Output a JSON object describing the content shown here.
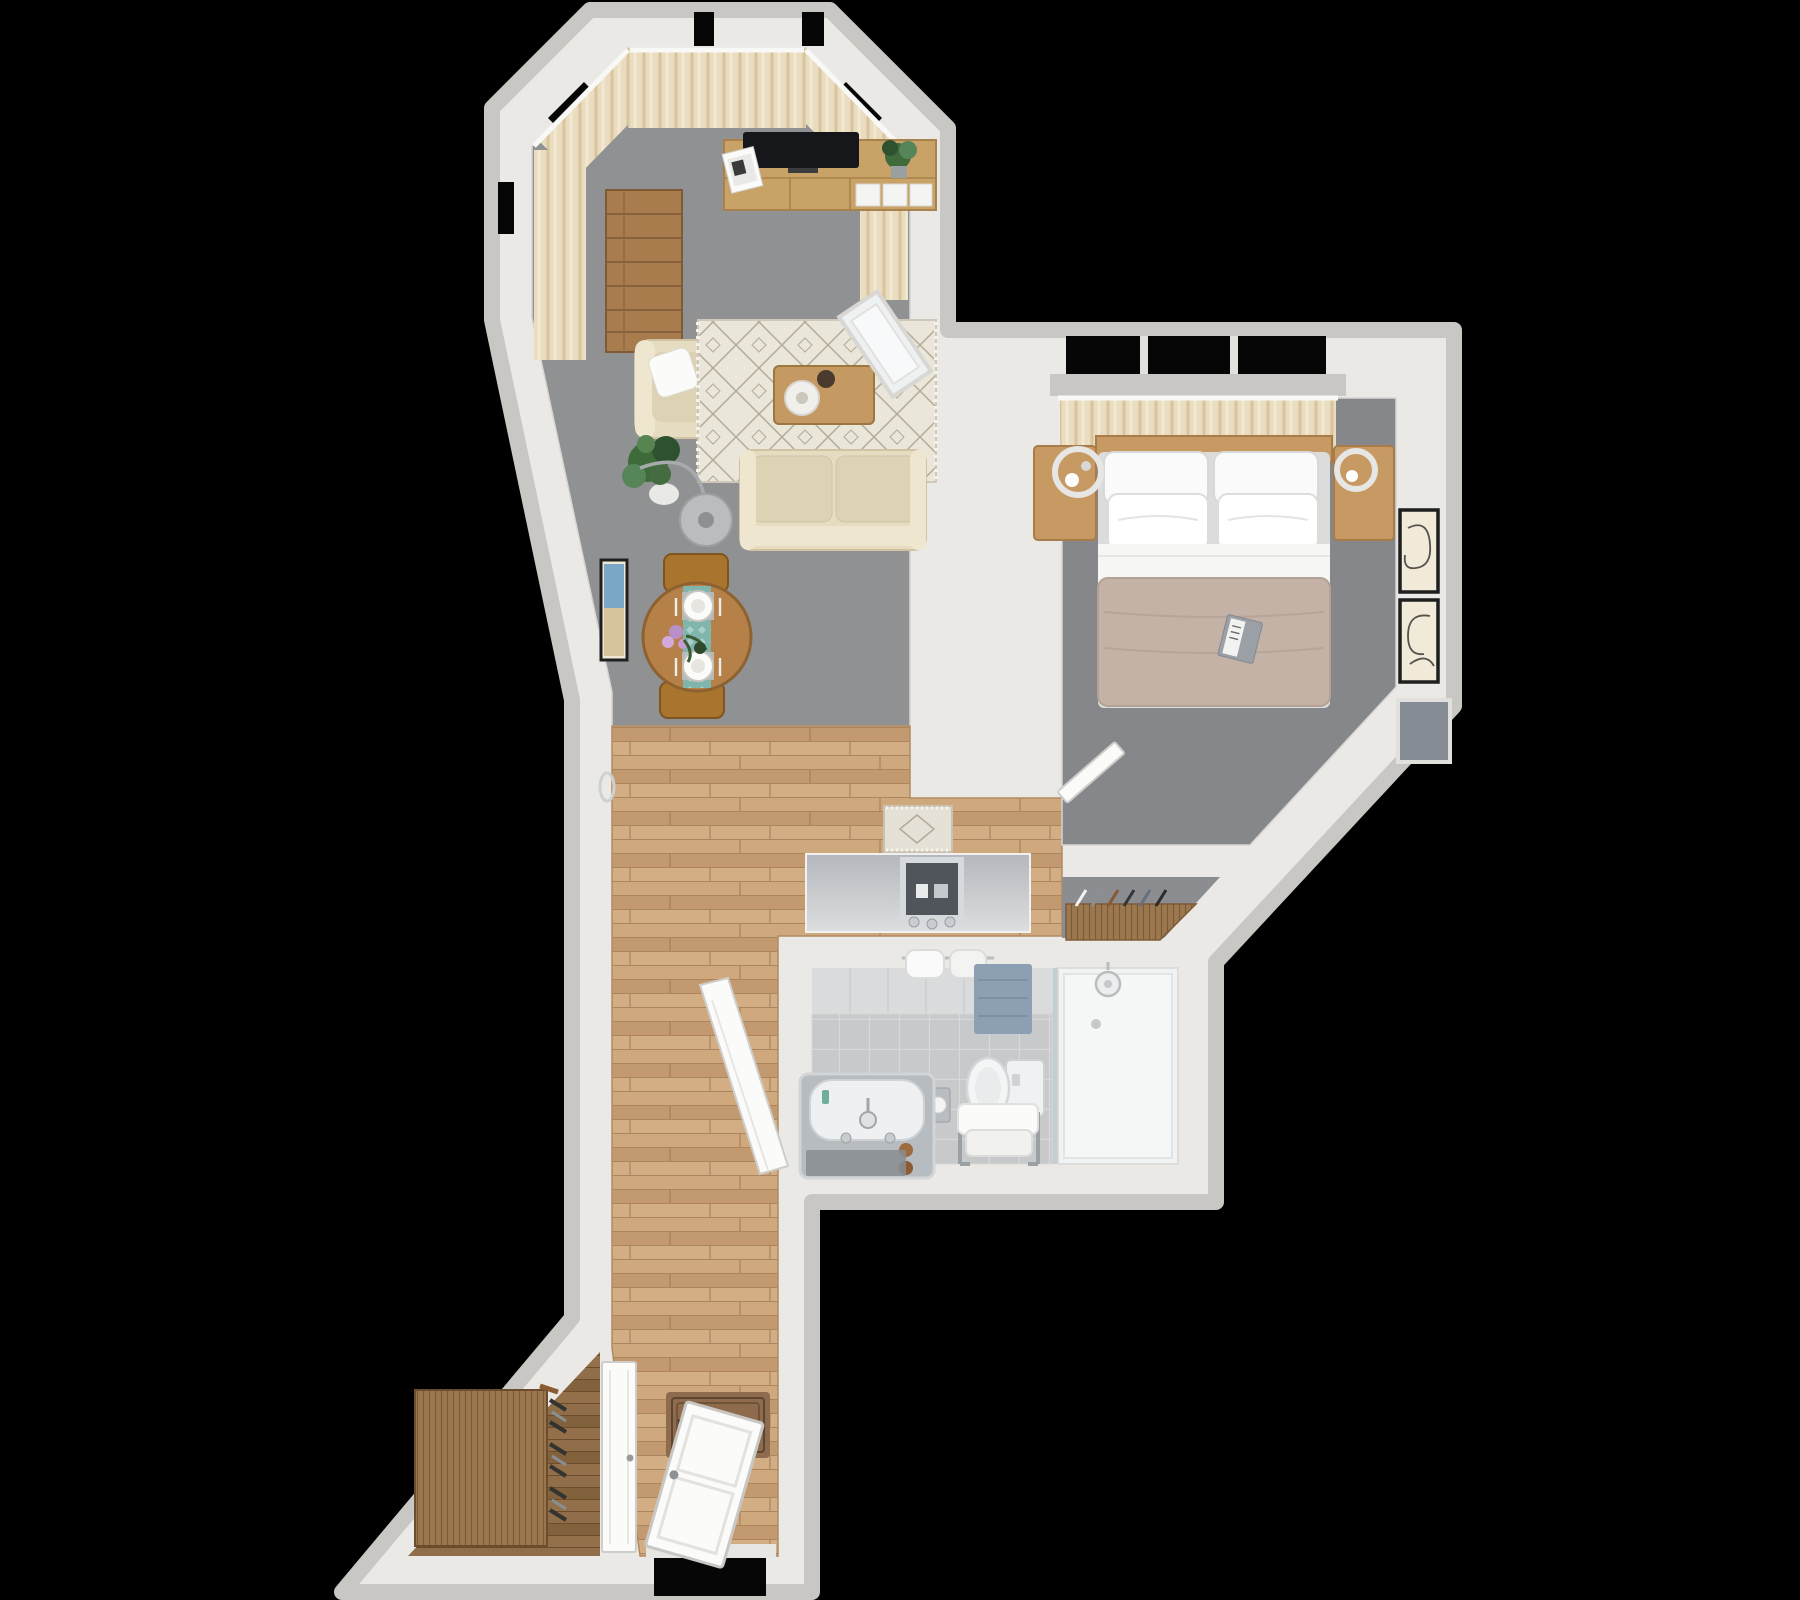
{
  "scene": {
    "kind": "3d-floor-plan-top-down-render",
    "background": "#000000",
    "mat_text": "Welcome"
  },
  "palette": {
    "background": "#000000",
    "wall": "#ebe9e5",
    "wall_bevel": "#c9c7c3",
    "carpet_living": "#8f9193",
    "carpet_bedroom": "#85878a",
    "carpet_closet": "#8b8d90",
    "wood_floor": "#c9a277",
    "wood_dark": "#8a6a4a",
    "curtain": "#e9dcc0",
    "sofa_beige": "#e6dcc2",
    "rug_cream": "#eae6da",
    "blanket_taupe": "#c3b2a5",
    "runner_teal": "#7fb5ad",
    "mat_brown": "#8d6b4c",
    "tile_gray": "#c7c9ca",
    "shower_white": "#f1f2f2",
    "tv_black": "#15171a"
  },
  "rooms": [
    {
      "name": "living-room",
      "floor": "gray carpet",
      "furniture": [
        "bay window curtains",
        "tv console",
        "tv",
        "plant on console",
        "magazines",
        "tall wooden shelf",
        "armchair with pillow",
        "potted plant",
        "arc floor lamp",
        "patterned cream rug",
        "coffee table with tray and bowl",
        "two-seat sofa",
        "round dining table",
        "teal table runner",
        "two place settings",
        "flower vase",
        "two dining chairs",
        "framed wall art",
        "wall sconce ring",
        "leaning mirror"
      ]
    },
    {
      "name": "bedroom",
      "floor": "gray carpet",
      "furniture": [
        "window with curtains",
        "double bed with four pillows",
        "white sheet",
        "taupe blanket",
        "open book",
        "left nightstand",
        "right nightstand",
        "two ring lamps",
        "two framed line-art prints",
        "gray wall panel",
        "open door"
      ]
    },
    {
      "name": "closet-corridor",
      "floor": "gray carpet",
      "furniture": [
        "wardrobe rail with hangers"
      ]
    },
    {
      "name": "bathroom",
      "floor": "gray tile",
      "furniture": [
        "marble bathtub with faucet",
        "toilet",
        "toilet-paper holder",
        "towel bench with towels",
        "blue bath mat",
        "hanging towels",
        "walk-in shower with glass panel",
        "shower head",
        "open door"
      ]
    },
    {
      "name": "hallway",
      "floor": "wood planks",
      "furniture": [
        "gray console with square mirror",
        "small patterned runner rug",
        "welcome mat",
        "front door",
        "storage door"
      ]
    },
    {
      "name": "storage-nook",
      "floor": "dark wood",
      "furniture": [
        "shoe rack with shoes"
      ]
    }
  ]
}
